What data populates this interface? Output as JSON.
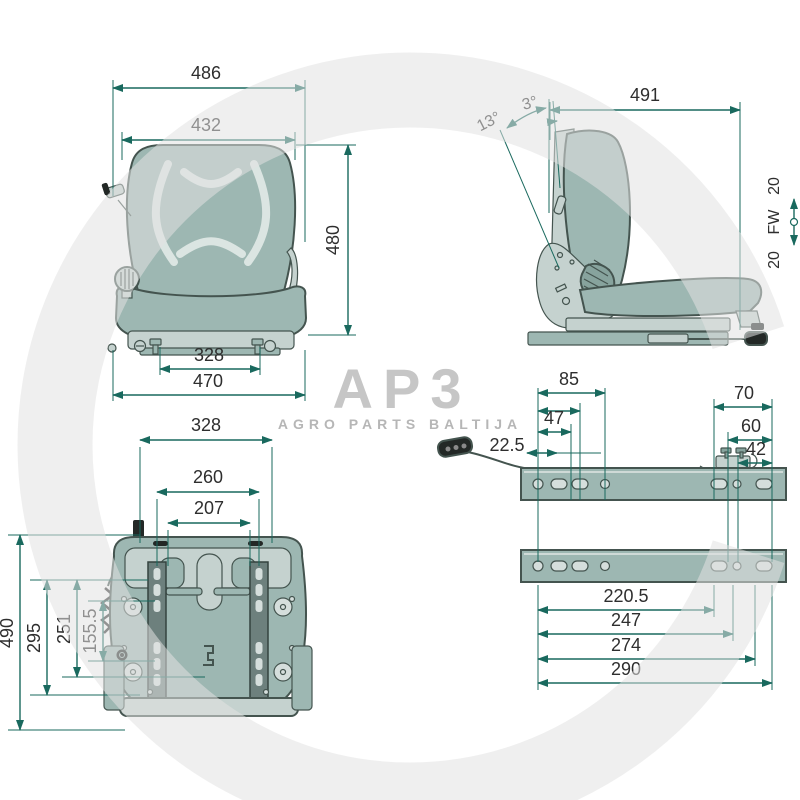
{
  "watermark": {
    "logo": "AP3",
    "subtitle": "AGRO PARTS BALTIJA"
  },
  "front": {
    "width_top": "486",
    "width_backrest": "432",
    "height": "480",
    "mount_spacing": "328",
    "width_base": "470"
  },
  "side": {
    "depth": "491",
    "angle_backrest": "13°",
    "angle_seat": "3°",
    "travel_up": "20",
    "travel_label": "FW",
    "travel_down": "20"
  },
  "bottom": {
    "spacing_outer": "328",
    "spacing_mid": "260",
    "spacing_inner": "207",
    "length_total": "490",
    "length_a": "295",
    "length_b": "251",
    "length_c": "155.5"
  },
  "rails": {
    "a": "85",
    "b": "47",
    "c": "22.5",
    "d": "70",
    "e": "60",
    "f": "42",
    "g": "220.5",
    "h": "247",
    "i": "274",
    "j": "290"
  },
  "colors": {
    "dimension_line": "#19695e",
    "seat_body": "#9db7b2",
    "seat_light": "#c5d2cf",
    "outline": "#44544f",
    "watermark_gray": "#e2e2e2"
  }
}
